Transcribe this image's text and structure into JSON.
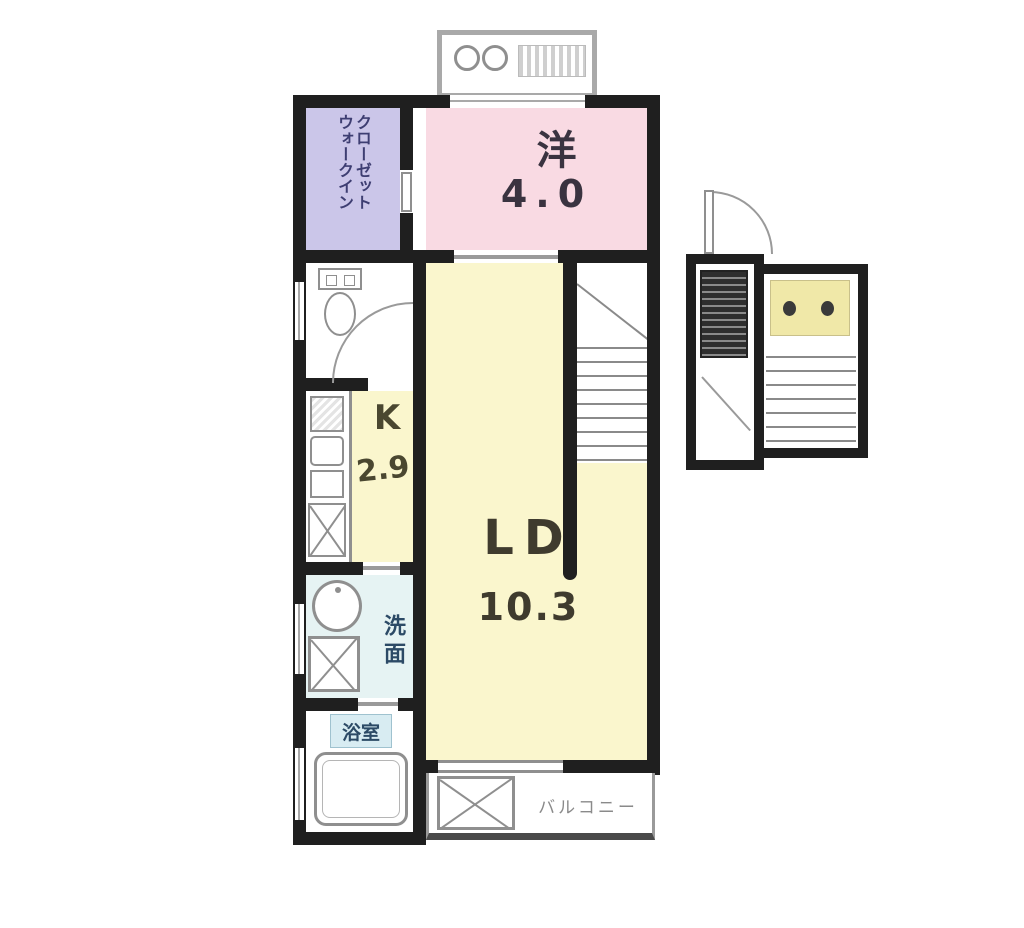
{
  "floorplan": {
    "type": "apartment-floor-plan",
    "rooms": {
      "wic": {
        "label_line1": "ウォークイン",
        "label_line2": "クローゼット"
      },
      "western": {
        "name": "洋",
        "size": "4.0"
      },
      "living_dining": {
        "name": "LD",
        "size": "10.3"
      },
      "kitchen": {
        "name": "K",
        "size": "2.9"
      },
      "washroom": {
        "label": "洗面"
      },
      "bathroom": {
        "label": "浴室"
      },
      "balcony": {
        "label": "バルコニー"
      }
    },
    "colors": {
      "wall": "#1f1f1f",
      "wic_fill": "#cbc6e9",
      "western_fill": "#f9dae3",
      "ld_kitchen_fill": "#faf6cd",
      "washroom_fill": "#e6f3f3",
      "bath_label_fill": "#d8ecf2",
      "landing_fill": "#f0e8a8",
      "outline_gray": "#8f8f8f",
      "text_dark": "#3f3b2e",
      "text_navy": "#2c4a66",
      "text_indigo": "#3e3e72",
      "balcony_text": "#8a8a8a"
    }
  }
}
